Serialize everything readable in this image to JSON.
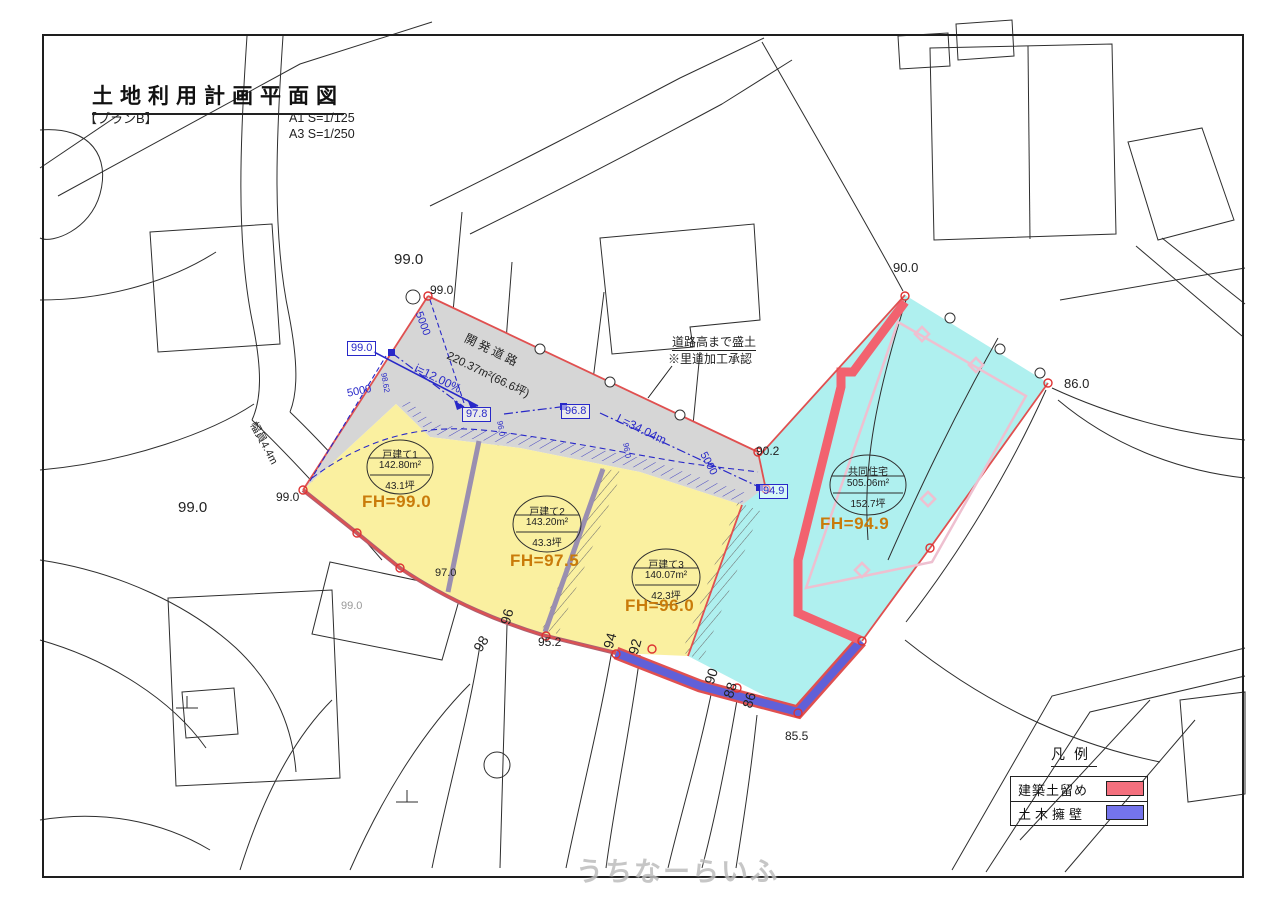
{
  "title": {
    "main": "土地利用計画平面図",
    "plan": "【プランB】",
    "scale_a1": "A1 S=1/125",
    "scale_a3": "A3 S=1/250"
  },
  "road": {
    "name": "開発道路",
    "area": "220.37m²(66.6坪)",
    "slope": "i=12.00%",
    "length": "L=34.04m",
    "width": "幅員4.4m",
    "dim_5000": "5000"
  },
  "note": {
    "line1": "道路高まで盛土",
    "line2": "※里道加工承認"
  },
  "parcels": [
    {
      "name": "戸建て1",
      "area": "142.80m²",
      "tsubo": "43.1坪",
      "fh": "FH=99.0"
    },
    {
      "name": "戸建て2",
      "area": "143.20m²",
      "tsubo": "43.3坪",
      "fh": "FH=97.5"
    },
    {
      "name": "戸建て3",
      "area": "140.07m²",
      "tsubo": "42.3坪",
      "fh": "FH=96.0"
    },
    {
      "name": "共同住宅",
      "area": "505.06m²",
      "tsubo": "152.7坪",
      "fh": "FH=94.9"
    }
  ],
  "dim_boxes": {
    "b1": "99.0",
    "b2": "97.8",
    "b3": "96.8",
    "b4": "94.9"
  },
  "spot_dims": {
    "s1": "98.62",
    "s2": "96.0",
    "s3": "96.0"
  },
  "elevations": {
    "top": "99.0",
    "top_small": "99.0",
    "left": "99.0",
    "left_small": "99.0",
    "base": "99.0",
    "p970": "97.0",
    "p952": "95.2",
    "p902": "90.2",
    "p900": "90.0",
    "p860": "86.0",
    "p855": "85.5"
  },
  "contours": [
    "98",
    "96",
    "94",
    "92",
    "90",
    "88",
    "86"
  ],
  "legend": {
    "title": "凡例",
    "items": [
      {
        "label": "建築土留め",
        "color": "#f4707e"
      },
      {
        "label": "土木擁壁",
        "color": "#7474ec"
      }
    ]
  },
  "watermark": "うちなーらいふ",
  "colors": {
    "residential_yellow": "#faf0a0",
    "apartment_cyan": "#aff0ef",
    "road_gray": "#d6d6d6",
    "wall_red": "#f2626f",
    "wall_blue": "#6060d8",
    "boundary_red": "#e05050",
    "dimension_blue": "#2828c8",
    "fh_orange": "#c97b0a"
  }
}
